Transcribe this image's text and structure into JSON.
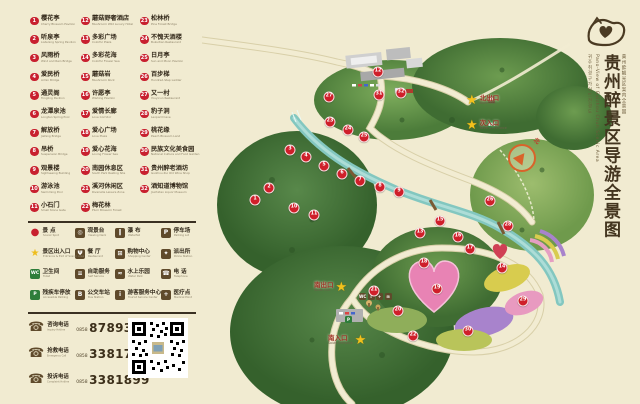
{
  "title_block": {
    "chinese": "贵州醉景区导游全景图",
    "english": "Pano-View of Guizhou Chun Scenic Area",
    "korean": "귀주취경구가이드전경도",
    "japanese": "貴州酔観光区案内全景図"
  },
  "colors": {
    "background": "#f1ebd1",
    "marker_red": "#cf1f2a",
    "legend_brown": "#5f4a2b",
    "star_gold": "#f2c11d",
    "river": "#83c7c0"
  },
  "attractions": [
    {
      "n": 1,
      "zh": "樱花亭",
      "en": "Cherry Blossom Pavilion"
    },
    {
      "n": 2,
      "zh": "听泉亭",
      "en": "Listening Spring Pavilion"
    },
    {
      "n": 3,
      "zh": "风雨桥",
      "en": "Wind and Rain Bridge"
    },
    {
      "n": 4,
      "zh": "爱民桥",
      "en": "Aimin Bridge"
    },
    {
      "n": 5,
      "zh": "通灵阁",
      "en": "Tongling Pavilion"
    },
    {
      "n": 6,
      "zh": "龙潭泉池",
      "en": "Longtan Spring Pool"
    },
    {
      "n": 7,
      "zh": "解放桥",
      "en": "Jiefang Bridge"
    },
    {
      "n": 8,
      "zh": "吊桥",
      "en": "Suspension Bridge"
    },
    {
      "n": 9,
      "zh": "观景楼",
      "en": "Sightseeing Building"
    },
    {
      "n": 10,
      "zh": "游泳池",
      "en": "Swimming Pool"
    },
    {
      "n": 11,
      "zh": "小石门",
      "en": "Small Stone Gate"
    },
    {
      "n": 12,
      "zh": "蘑菇野奢酒店",
      "en": "Mushroom Wild Luxury Hotel"
    },
    {
      "n": 13,
      "zh": "多彩广场",
      "en": "Colorful Plaza"
    },
    {
      "n": 14,
      "zh": "多彩花海",
      "en": "Colorful Flower Sea"
    },
    {
      "n": 15,
      "zh": "蘑菇岩",
      "en": "Mushroom Rock"
    },
    {
      "n": 16,
      "zh": "许愿亭",
      "en": "Wishing Pavilion"
    },
    {
      "n": 17,
      "zh": "爱情长廊",
      "en": "Love Corridor"
    },
    {
      "n": 18,
      "zh": "爱心广场",
      "en": "Love Plaza"
    },
    {
      "n": 19,
      "zh": "爱心花海",
      "en": "Loving Flower Sea"
    },
    {
      "n": 20,
      "zh": "南园休息区",
      "en": "South Park Resting Site"
    },
    {
      "n": 21,
      "zh": "溪河休闲区",
      "en": "Riverside Leisure Zone"
    },
    {
      "n": 22,
      "zh": "梅花林",
      "en": "Plum Blossom Forest"
    },
    {
      "n": 23,
      "zh": "松林桥",
      "en": "Pine Forest Bridge"
    },
    {
      "n": 24,
      "zh": "不愧天酒楼",
      "en": "Bukuitian Restaurant"
    },
    {
      "n": 25,
      "zh": "日月亭",
      "en": "Sun and Moon Pavilion"
    },
    {
      "n": 26,
      "zh": "百步梯",
      "en": "Hundred-Step Ladder"
    },
    {
      "n": 27,
      "zh": "又一村",
      "en": "Youyicun Restaurant"
    },
    {
      "n": 28,
      "zh": "豹子洞",
      "en": "Leopard Cave"
    },
    {
      "n": 29,
      "zh": "桃花缘",
      "en": "Peach Blossom Land"
    },
    {
      "n": 30,
      "zh": "民族文化美食园",
      "en": "National Culture and Food Garden"
    },
    {
      "n": 31,
      "zh": "贵州醉老酒坊",
      "en": "Guizhou Zui Old Wine Shop"
    },
    {
      "n": 32,
      "zh": "酒知道博物馆",
      "en": "Jiuzhidao Liquor Museum"
    }
  ],
  "facilities": [
    {
      "name": "scenic-spot",
      "glyph": "●",
      "kind": "dot",
      "zh": "景 点",
      "en": "Scenic Spot"
    },
    {
      "name": "viewing-deck",
      "glyph": "◎",
      "kind": "brown",
      "zh": "观景台",
      "en": "Viewing Deck"
    },
    {
      "name": "waterfall",
      "glyph": "‖",
      "kind": "brown",
      "zh": "瀑 布",
      "en": "Waterfall"
    },
    {
      "name": "parking-lot",
      "glyph": "P",
      "kind": "brown",
      "zh": "停车场",
      "en": "Parking Lot"
    },
    {
      "name": "entrance-exit",
      "glyph": "★",
      "kind": "star",
      "zh": "景区出入口",
      "en": "Entrance & Exit of Scenic Area"
    },
    {
      "name": "restaurant",
      "glyph": "Ψ",
      "kind": "brown",
      "zh": "餐 厅",
      "en": "Restaurant"
    },
    {
      "name": "shopping-center",
      "glyph": "⊞",
      "kind": "brown",
      "zh": "购物中心",
      "en": "Shopping Center"
    },
    {
      "name": "police-station",
      "glyph": "✦",
      "kind": "brown",
      "zh": "派出所",
      "en": "Police Station"
    },
    {
      "name": "toilet",
      "glyph": "WC",
      "kind": "green",
      "zh": "卫生间",
      "en": "Toilet"
    },
    {
      "name": "self-service",
      "glyph": "≡",
      "kind": "brown",
      "zh": "自助服务",
      "en": "Self Service"
    },
    {
      "name": "water-park",
      "glyph": "≈",
      "kind": "brown",
      "zh": "水上乐园",
      "en": "Water Park"
    },
    {
      "name": "telephone",
      "glyph": "☎",
      "kind": "brown",
      "zh": "电 话",
      "en": "Telephone"
    },
    {
      "name": "accessible-parking",
      "glyph": "P",
      "kind": "green",
      "zh": "残疾车停放",
      "en": "Accessible Parking"
    },
    {
      "name": "bus-station",
      "glyph": "B",
      "kind": "brown",
      "zh": "公交车站",
      "en": "Bus Station"
    },
    {
      "name": "tourist-center",
      "glyph": "i",
      "kind": "brown",
      "zh": "游客服务中心",
      "en": "Tourist Service Center"
    },
    {
      "name": "medical-point",
      "glyph": "+",
      "kind": "brown",
      "zh": "医疗点",
      "en": "Medical Point"
    }
  ],
  "contacts": [
    {
      "zh": "咨询电话",
      "en": "Inquiry Hotline",
      "code": "0858",
      "number": "8789308"
    },
    {
      "zh": "抢救电话",
      "en": "Emergency Call",
      "code": "0858",
      "number": "3381788"
    },
    {
      "zh": "投诉电话",
      "en": "Complaint Hotline",
      "code": "0858",
      "number": "3381899"
    }
  ],
  "map": {
    "compass_label": "北",
    "exits": [
      {
        "zh": "北出口",
        "en": "North Exit",
        "x": 264,
        "y": 101,
        "star": "left"
      },
      {
        "zh": "次入口",
        "en": "Second Entrance",
        "x": 264,
        "y": 126,
        "star": "left"
      },
      {
        "zh": "南出口",
        "en": "South Exit",
        "x": 112,
        "y": 288,
        "star": "right"
      },
      {
        "zh": "南入口",
        "en": "South Entrance",
        "x": 126,
        "y": 341,
        "star": "right"
      }
    ],
    "markers": [
      {
        "n": 1,
        "x": 53,
        "y": 200
      },
      {
        "n": 2,
        "x": 67,
        "y": 188
      },
      {
        "n": 3,
        "x": 88,
        "y": 150
      },
      {
        "n": 4,
        "x": 104,
        "y": 157
      },
      {
        "n": 5,
        "x": 122,
        "y": 166
      },
      {
        "n": 6,
        "x": 140,
        "y": 174
      },
      {
        "n": 7,
        "x": 158,
        "y": 181
      },
      {
        "n": 8,
        "x": 178,
        "y": 187
      },
      {
        "n": 9,
        "x": 197,
        "y": 192
      },
      {
        "n": 10,
        "x": 92,
        "y": 208
      },
      {
        "n": 11,
        "x": 112,
        "y": 215
      },
      {
        "n": 12,
        "x": 176,
        "y": 72
      },
      {
        "n": 13,
        "x": 218,
        "y": 233
      },
      {
        "n": 14,
        "x": 300,
        "y": 268
      },
      {
        "n": 15,
        "x": 238,
        "y": 221
      },
      {
        "n": 16,
        "x": 256,
        "y": 237
      },
      {
        "n": 17,
        "x": 268,
        "y": 249
      },
      {
        "n": 18,
        "x": 222,
        "y": 263
      },
      {
        "n": 19,
        "x": 235,
        "y": 289
      },
      {
        "n": 20,
        "x": 196,
        "y": 311
      },
      {
        "n": 21,
        "x": 172,
        "y": 291
      },
      {
        "n": 22,
        "x": 211,
        "y": 336
      },
      {
        "n": 23,
        "x": 128,
        "y": 122
      },
      {
        "n": 24,
        "x": 146,
        "y": 130
      },
      {
        "n": 25,
        "x": 162,
        "y": 137
      },
      {
        "n": 26,
        "x": 288,
        "y": 201
      },
      {
        "n": 27,
        "x": 127,
        "y": 97
      },
      {
        "n": 28,
        "x": 306,
        "y": 226
      },
      {
        "n": 29,
        "x": 321,
        "y": 301
      },
      {
        "n": 30,
        "x": 266,
        "y": 331
      },
      {
        "n": 31,
        "x": 177,
        "y": 95
      },
      {
        "n": 32,
        "x": 199,
        "y": 93
      }
    ]
  }
}
